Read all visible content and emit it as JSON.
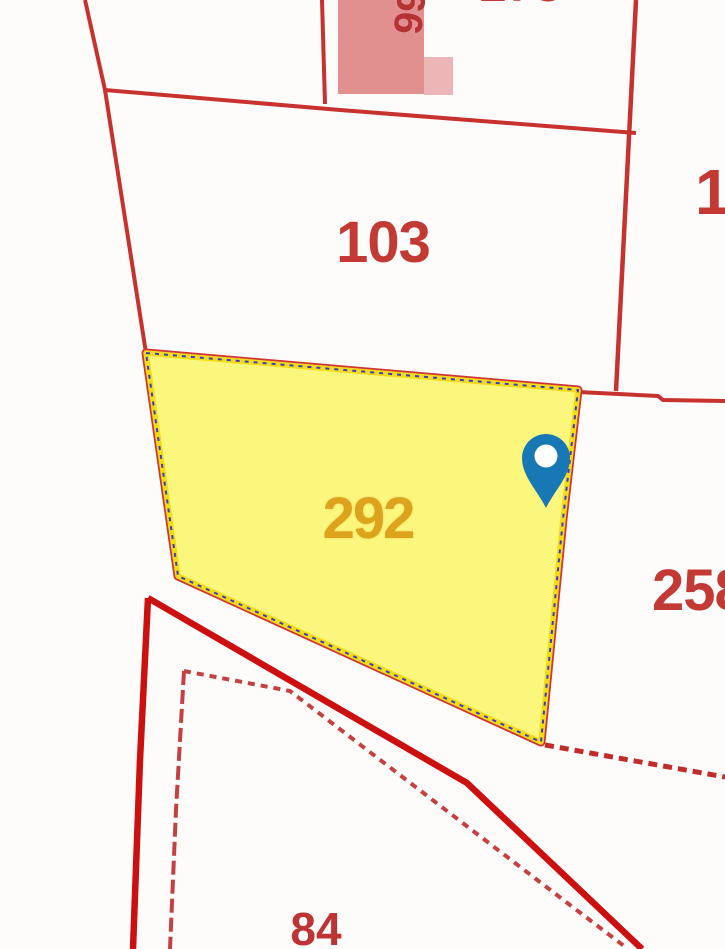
{
  "app": {
    "type": "cadastral-map-viewer"
  },
  "map": {
    "selected_parcel_id": "292",
    "labels": {
      "parcel_103": "103",
      "parcel_292": "292",
      "parcel_258": "258",
      "parcel_84": "84",
      "parcel_right_partial": "1",
      "building_rotated": "66",
      "top_edge_partial": "173"
    },
    "marker": {
      "name": "location-pin",
      "color": "#1878b6"
    },
    "colors": {
      "boundary_red": "#c8322e",
      "thick_boundary_red": "#cc1010",
      "stepped_boundary_red": "#c54040",
      "label_red": "#c23a33",
      "selected_fill_yellow": "#fbf77d",
      "selected_border_yellow": "#f2dc17",
      "selected_dash_blue": "#3b3bc8",
      "selected_label_orange": "#dda31d",
      "building_fill_pink": "#e18f8f",
      "building_fill_pink_light": "#edb6b6",
      "pin_blue": "#1878b6"
    }
  }
}
